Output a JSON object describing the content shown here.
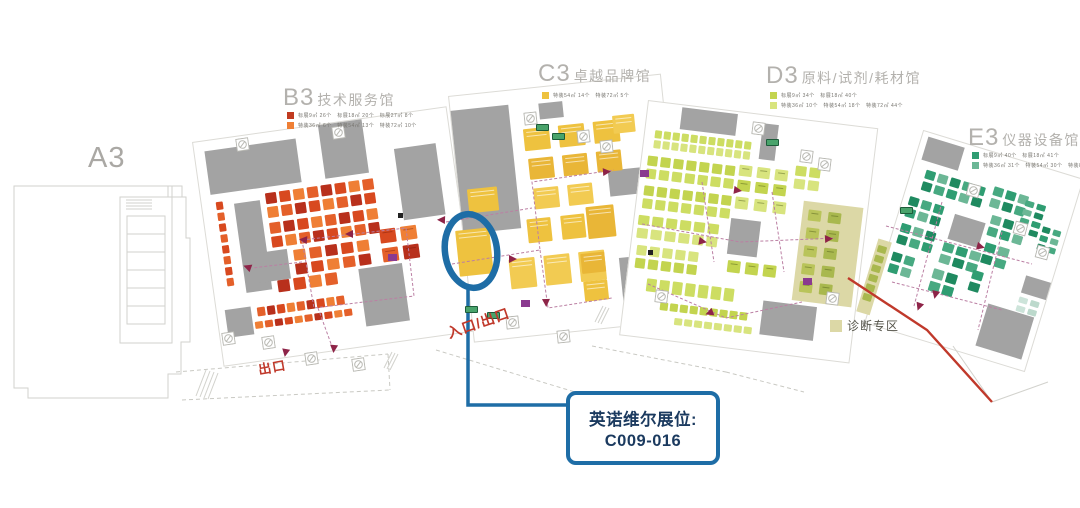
{
  "map": {
    "halls": {
      "a3": {
        "label": "A3"
      },
      "b3": {
        "code": "B3",
        "name": "技术服务馆"
      },
      "c3": {
        "code": "C3",
        "name": "卓越品牌馆"
      },
      "d3": {
        "code": "D3",
        "name": "原料/试剂/耗材馆"
      },
      "e3": {
        "code": "E3",
        "name": "仪器设备馆"
      }
    },
    "legends": {
      "b3": [
        {
          "swatch": "#c13b20",
          "text": "标展9㎡ 26个　标展18㎡ 20个　标展27㎡ 8个"
        },
        {
          "swatch": "#ef7f35",
          "text": "特装36㎡ 6个　特装54㎡ 13个　特装72㎡ 10个"
        }
      ],
      "c3": [
        {
          "swatch": "#eec23f",
          "text": "特装54㎡ 14个　特装72㎡ 5个"
        }
      ],
      "d3": [
        {
          "swatch": "#c3d44f",
          "text": "标展9㎡ 34个　标展18㎡ 40个"
        },
        {
          "swatch": "#d8e47e",
          "text": "特装36㎡ 10个　特装54㎡ 18个　特装72㎡ 44个"
        }
      ],
      "e3": [
        {
          "swatch": "#2f9d72",
          "text": "标展9㎡ 40个　标展18㎡ 41个"
        },
        {
          "swatch": "#6cb796",
          "text": "特装36㎡ 31个　特装54㎡ 30个　特装81㎡ 34个"
        }
      ]
    },
    "labels": {
      "entrance_exit": "入口/出口",
      "exit": "出口",
      "diagnostic_zone": "诊断专区"
    },
    "callout": {
      "line1": "英诺维尔展位:",
      "line2": "C009-016"
    },
    "colors": {
      "accent_blue": "#1e6da6",
      "callout_text": "#1b3a5f",
      "red_label": "#c0392b",
      "hall_title_gray": "#b3b1ad",
      "block_gray": "#a3a3a3",
      "diagnostic_zone_fill": "#dcd8a6",
      "aisle_dash": "#bb7fa3",
      "arrow": "#8e2448",
      "purple_icon": "#8a3a8f",
      "b3_palette": [
        "#d8491f",
        "#b8301c",
        "#e4602a",
        "#ef7f35"
      ],
      "c3_palette": [
        "#eec23f",
        "#e9b637",
        "#f2cb52"
      ],
      "d3_palette": [
        "#cddd62",
        "#c3d44f",
        "#d8e47e"
      ],
      "e3_palette": [
        "#2f9d72",
        "#47a981",
        "#1f8a60",
        "#6cb796"
      ],
      "olive_palette": [
        "#b9c45a",
        "#a9b84e"
      ],
      "light_teal_palette": [
        "#bcd9cc",
        "#cde4da"
      ]
    }
  }
}
